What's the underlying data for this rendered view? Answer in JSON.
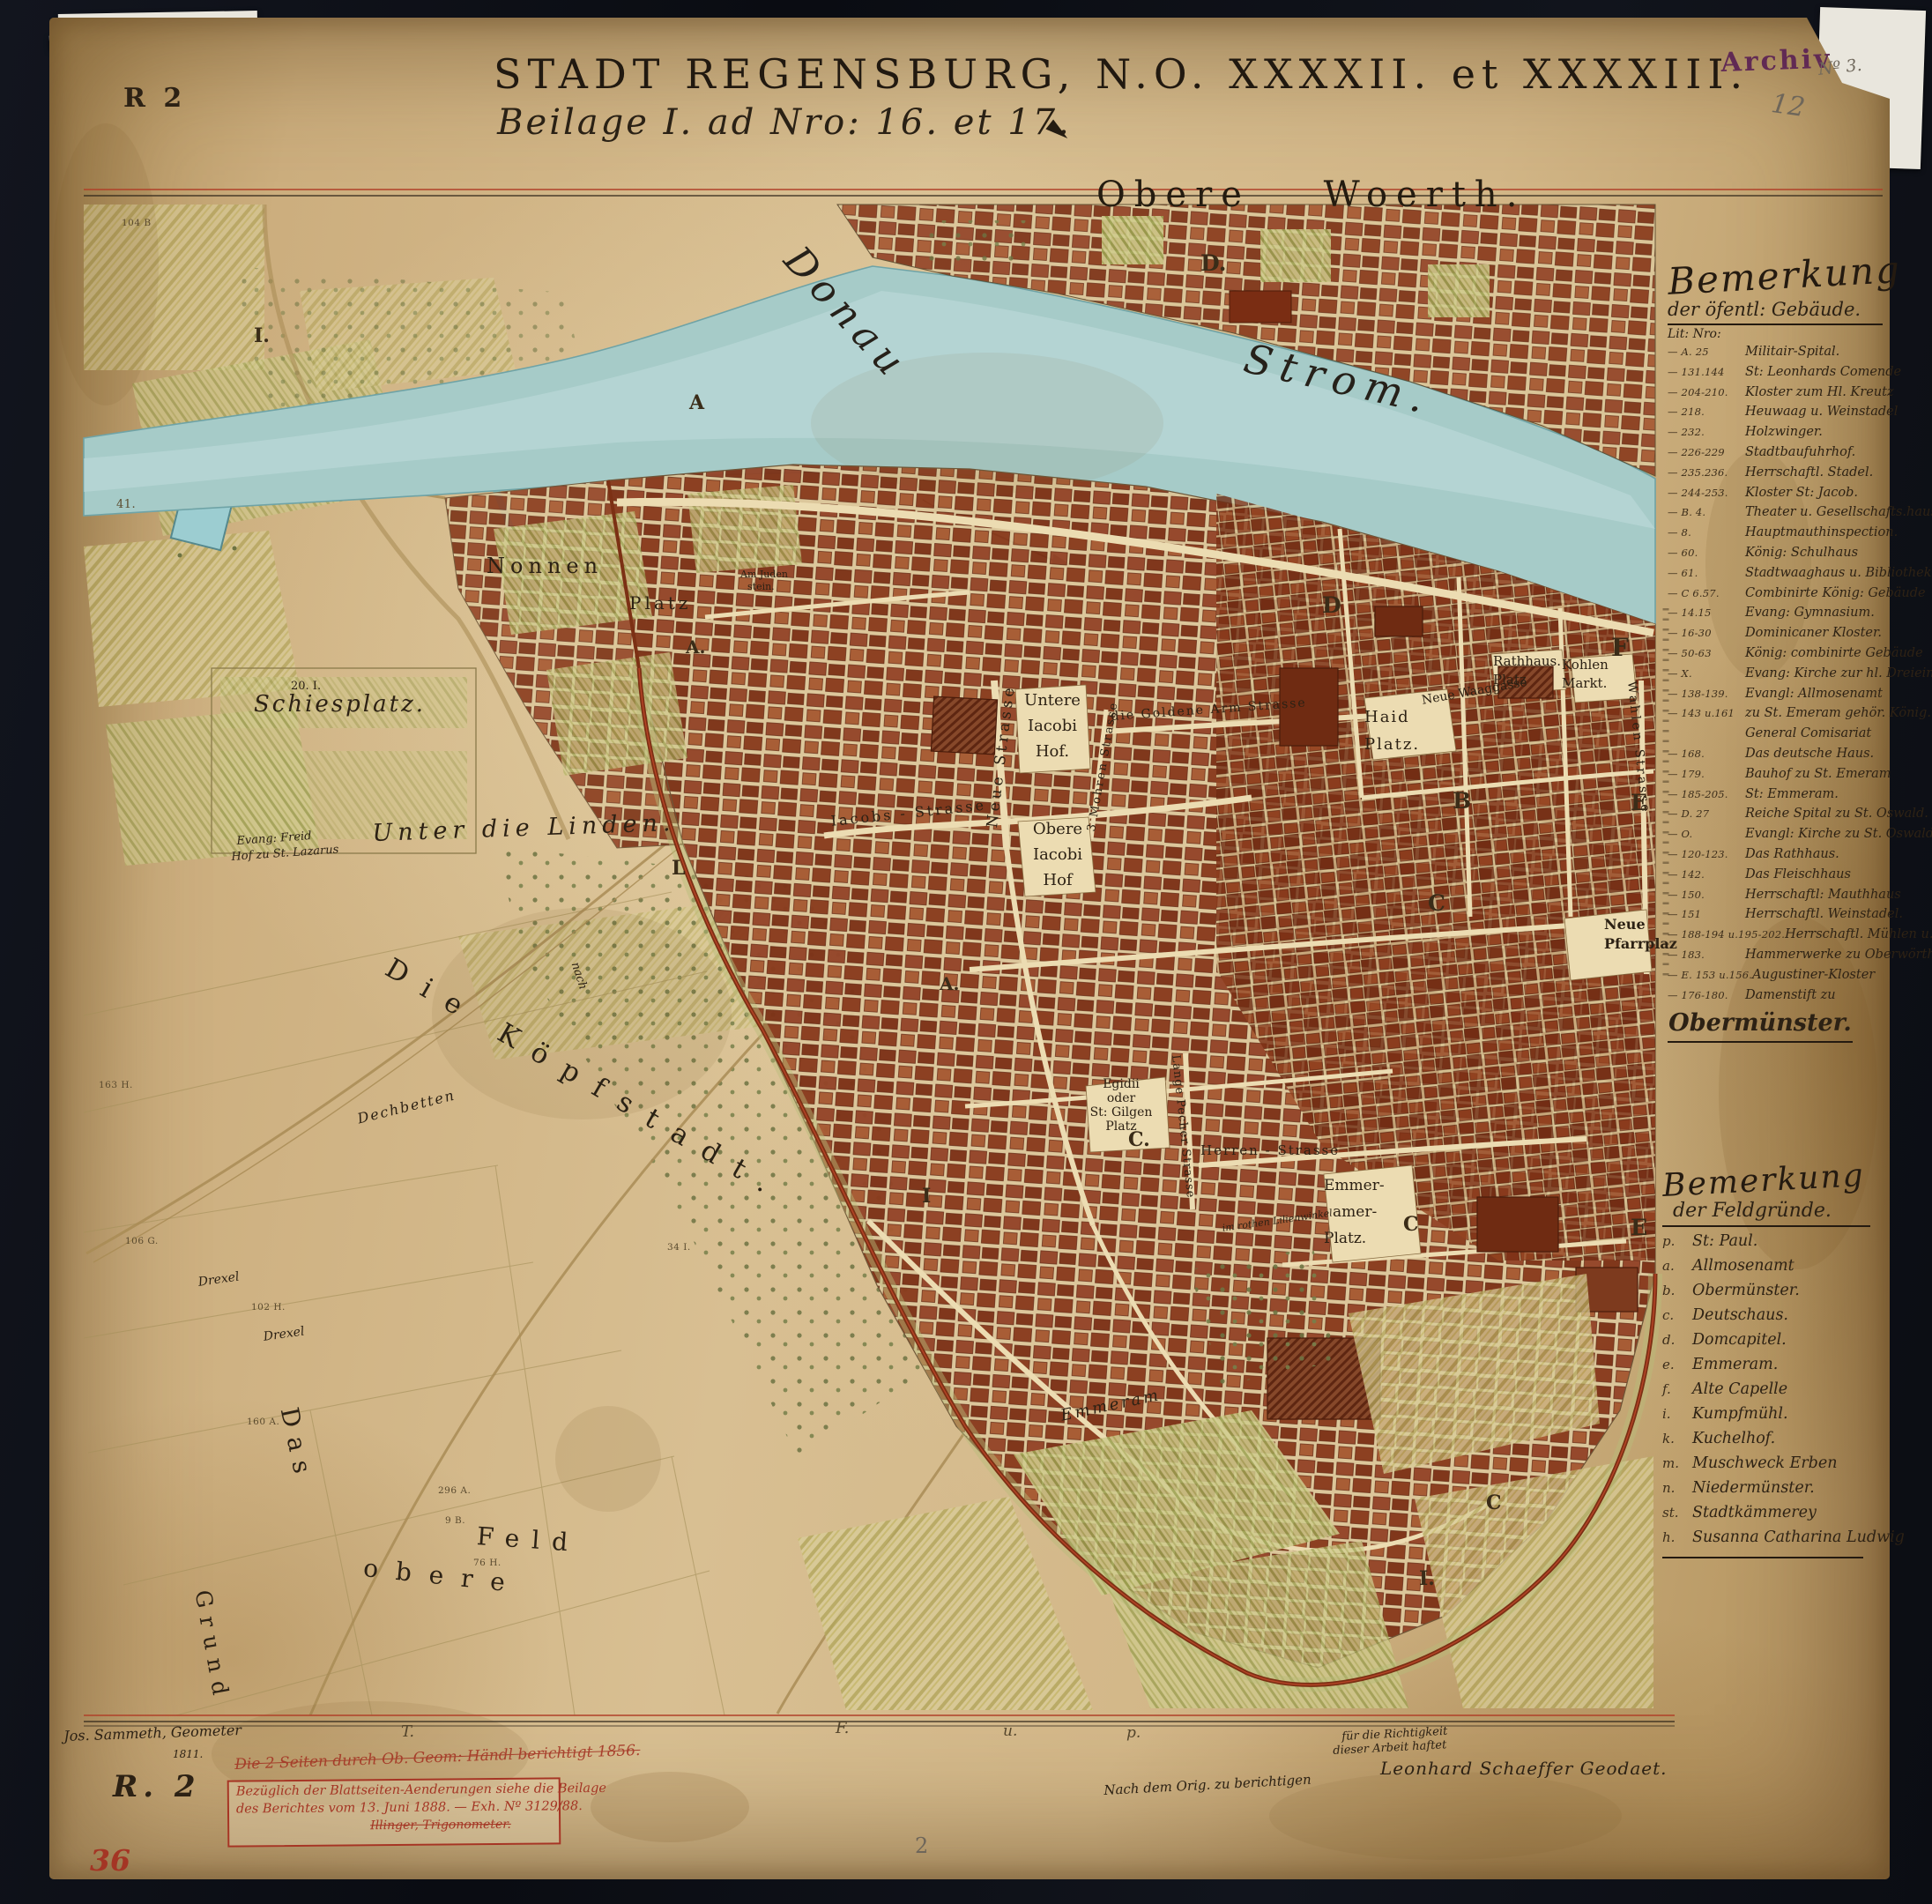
{
  "plate": {
    "top_left_mark": "R 2",
    "bottom_left_mark": "R. 2",
    "red_inventory_number": "36",
    "page_number": "2"
  },
  "stamp": {
    "archiv": "Archiv",
    "number": "Nº 3.",
    "pencil_number": "12"
  },
  "title": {
    "line1": "STADT REGENSBURG, N.O. XXXXII. et XXXXIII.",
    "line2": "Beilage I.  ad Nro: 16. et 17."
  },
  "river": {
    "name_upper": "Donau",
    "name_lower": "Strom.",
    "island_label": "Obere Woerth.",
    "island_letter": "D."
  },
  "map_labels": {
    "nonnen": "Nonnen",
    "nonnen_platz": "Platz",
    "judenstein_1": "Am Juden",
    "judenstein_2": "stein.",
    "schiessplatz_no": "20. I.",
    "schiessplatz": "Schiesplatz.",
    "unter_die_linden": "Unter die Linden.",
    "freidhof_1": "Evang: Freid",
    "freidhof_2": "Hof zu St. Lazarus",
    "koepfstadt": "Die Köpfstadt.",
    "dechbetten": "Dechbetten",
    "nach": "nach",
    "drexel_1": "Drexel",
    "drexel_2": "Drexel",
    "das": "Das",
    "obere": "obere",
    "feld": "Feld",
    "grund": "Grund",
    "untere_jacobi_1": "Untere",
    "untere_jacobi_2": "Iacobi",
    "untere_jacobi_3": "Hof.",
    "obere_jacobi_1": "Obere",
    "obere_jacobi_2": "Iacobi",
    "obere_jacobi_3": "Hof",
    "neue_strasse": "Neue Strasse",
    "jacobs_strasse": "Iacobs - Strasse",
    "goldene_arm_strasse": "die Goldene Arm Strasse",
    "mohren_strasse": "3 Mohren Strasse",
    "haid_1": "Haid",
    "haid_2": "Platz.",
    "rathhaus_1": "Rathhaus.",
    "rathhaus_2": "Platz",
    "kohlen_1": "Kohlen",
    "kohlen_2": "Markt.",
    "neue_waaggasse": "Neue Waaggasse",
    "neue_pfarrplatz_1": "Neue",
    "neue_pfarrplatz_2": "Pfarrplaz",
    "egidii_1": "Egidii",
    "egidii_2": "oder",
    "egidii_3": "St: Gilgen",
    "egidii_4": "Platz",
    "herren_strasse": "Herren - Strasse",
    "lange_pecher_strasse": "Lange Pecher Strasse",
    "emmeramer_1": "Emmer-",
    "emmeramer_2": "amer-",
    "emmeramer_3": "Platz.",
    "lilienwinkel": "im rothen Lilienwinkel",
    "wahlen_strasse": "Wahlen Strasse",
    "emmeram": "Emmeram"
  },
  "district_letters": {
    "i_nw": "I.",
    "a_nw": "A",
    "a_w": "A.",
    "l_gate": "L",
    "a_c": "A.",
    "d_city": "D",
    "b_city": "B",
    "c_city": "C",
    "c_gilgen": "C.",
    "c_emmeramer": "C",
    "c_south": "C",
    "e_east": "E",
    "e_south": "E",
    "f_east": "F",
    "i_mid": "I",
    "i_south": "I.",
    "t_margin": "T.",
    "f_margin": "F.",
    "u_margin": "u.",
    "p_margin": "p."
  },
  "parcel_numbers": {
    "p1": "104 B",
    "p2": "41.",
    "p3": "163 H.",
    "p4": "106 G.",
    "p5": "102 H.",
    "p6": "160 A.",
    "p7": "296 A.",
    "p8": "9 B.",
    "p9": "76 H.",
    "p10": "34 I."
  },
  "legend_buildings": {
    "title1": "Bemerkung",
    "title2": "der öfentl: Gebäude.",
    "lit": "Lit: Nro:",
    "items": [
      {
        "n": "— A. 25",
        "t": "Militair-Spital."
      },
      {
        "n": "— 131.144",
        "t": "St: Leonhards Comende"
      },
      {
        "n": "— 204-210.",
        "t": "Kloster zum Hl. Kreutz"
      },
      {
        "n": "— 218.",
        "t": "Heuwaag u. Weinstadel"
      },
      {
        "n": "— 232.",
        "t": "Holzwinger."
      },
      {
        "n": "— 226-229",
        "t": "Stadtbaufuhrhof."
      },
      {
        "n": "— 235.236.",
        "t": "Herrschaftl. Stadel."
      },
      {
        "n": "— 244-253.",
        "t": "Kloster St: Jacob."
      },
      {
        "n": "— B. 4.",
        "t": "Theater u. Gesellschafts.haus"
      },
      {
        "n": "— 8.",
        "t": "Hauptmauthinspection."
      },
      {
        "n": "— 60.",
        "t": "König: Schulhaus"
      },
      {
        "n": "— 61.",
        "t": "Stadtwaaghaus u. Bibliothek"
      },
      {
        "n": "— C 6.57.",
        "t": "Combinirte König: Gebäude"
      },
      {
        "n": "— 14.15",
        "t": "Evang: Gymnasium."
      },
      {
        "n": "— 16-30",
        "t": "Dominicaner Kloster."
      },
      {
        "n": "— 50-63",
        "t": "König: combinirte Gebäude"
      },
      {
        "n": "— X.",
        "t": "Evang: Kirche zur hl. Dreieinigkeit"
      },
      {
        "n": "— 138-139.",
        "t": "Evangl: Allmosenamt"
      },
      {
        "n": "— 143 u.161",
        "t": "zu St. Emeram gehör. König."
      },
      {
        "n": "",
        "t": "General Comisariat"
      },
      {
        "n": "— 168.",
        "t": "Das deutsche Haus."
      },
      {
        "n": "— 179.",
        "t": "Bauhof zu St. Emeram"
      },
      {
        "n": "— 185-205.",
        "t": "St: Emmeram."
      },
      {
        "n": "— D. 27",
        "t": "Reiche Spital zu St. Oswald."
      },
      {
        "n": "— O.",
        "t": "Evangl: Kirche zu St. Oswald."
      },
      {
        "n": "— 120-123.",
        "t": "Das Rathhaus."
      },
      {
        "n": "— 142.",
        "t": "Das Fleischhaus"
      },
      {
        "n": "— 150.",
        "t": "Herrschaftl: Mauthhaus"
      },
      {
        "n": "— 151",
        "t": "Herrschaftl. Weinstadel."
      },
      {
        "n": "— 188-194 u.195-202.",
        "t": "Herrschaftl. Mühlen u."
      },
      {
        "n": "— 183.",
        "t": "Hammerwerke zu Oberwörth."
      },
      {
        "n": "— E. 153 u.156.",
        "t": "Augustiner-Kloster"
      },
      {
        "n": "— 176-180.",
        "t": "Damenstift zu"
      }
    ],
    "footer": "Obermünster."
  },
  "legend_fields": {
    "title1": "Bemerkung",
    "title2": "der Feldgründe.",
    "items": [
      {
        "n": "p.",
        "t": "St: Paul."
      },
      {
        "n": "a.",
        "t": "Allmosenamt"
      },
      {
        "n": "b.",
        "t": "Obermünster."
      },
      {
        "n": "c.",
        "t": "Deutschaus."
      },
      {
        "n": "d.",
        "t": "Domcapitel."
      },
      {
        "n": "e.",
        "t": "Emmeram."
      },
      {
        "n": "f.",
        "t": "Alte Capelle"
      },
      {
        "n": "i.",
        "t": "Kumpfmühl."
      },
      {
        "n": "k.",
        "t": "Kuchelhof."
      },
      {
        "n": "m.",
        "t": "Muschweck Erben"
      },
      {
        "n": "n.",
        "t": "Niedermünster."
      },
      {
        "n": "st.",
        "t": "Stadtkämmerey"
      },
      {
        "n": "h.",
        "t": "Susanna Catharina Ludwig"
      }
    ]
  },
  "annotations": {
    "geometer_line": "Jos. Sammeth, Geometer",
    "geometer_year": "1811.",
    "red_note": "Die 2 Seiten durch Ob. Geom: Händl berichtigt 1856.",
    "box_line1": "Bezüglich der Blattseiten-Aenderungen siehe die Beilage",
    "box_line2": "des Berichtes vom 13. Juni 1888. — Exh. Nº 3129/88.",
    "box_signature": "Illinger, Trigonometer.",
    "certify_1": "für die Richtigkeit",
    "certify_2": "dieser Arbeit haftet",
    "certify_name": "Leonhard Schaeffer Geodaet.",
    "correction_note": "Nach dem Orig. zu berichtigen"
  }
}
